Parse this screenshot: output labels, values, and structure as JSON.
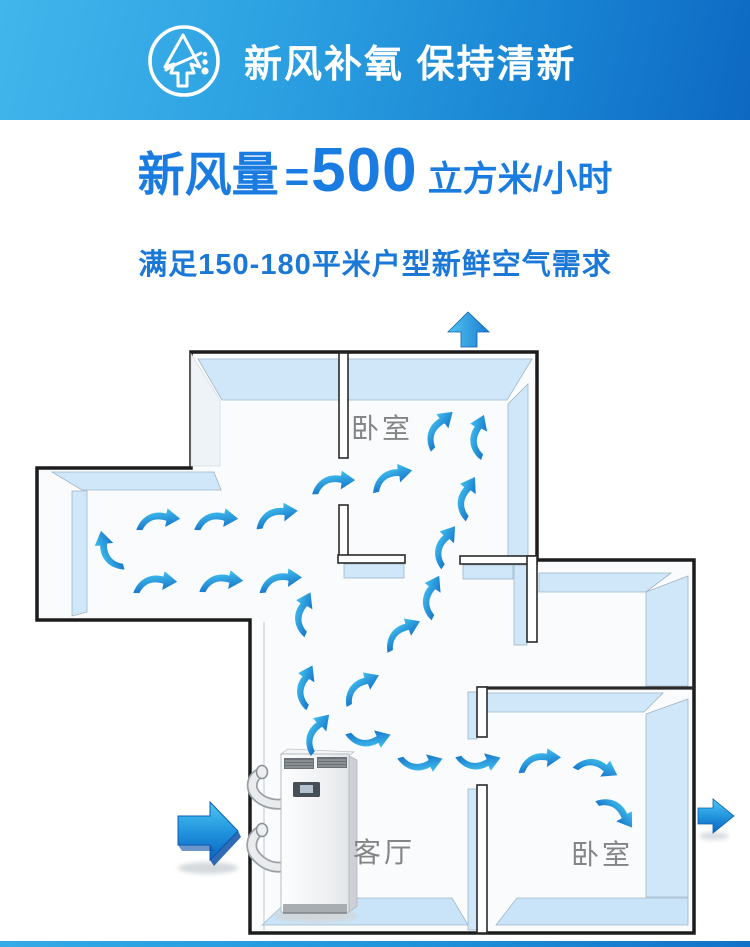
{
  "header": {
    "title": "新风补氧 保持清新",
    "icon": "fresh-air-tree-arrow-icon",
    "gradient": [
      "#41b6ec",
      "#0d68c2"
    ],
    "text_color": "#ffffff"
  },
  "headline": {
    "prefix": "新风量",
    "equals": "=",
    "value": "500",
    "unit": "立方米/小时",
    "color": "#1a7ce0"
  },
  "subtitle": {
    "text": "满足150-180平米户型新鲜空气需求",
    "color": "#1b78d6"
  },
  "floorplan": {
    "rooms": [
      {
        "label": "卧室",
        "position": "top"
      },
      {
        "label": "客厅",
        "position": "bottom-left"
      },
      {
        "label": "卧室",
        "position": "bottom-right"
      }
    ],
    "label_color": "#858585",
    "wall_outline_color": "#1c1c1c",
    "wall_face_color": "#cfe7f8",
    "floor_color": "#c9e4f8",
    "airflow_arrow_color": "#2aa0e2",
    "equipment": "ventilation-unit-cabinet",
    "icons": [
      "air-inlet-arrow-icon",
      "air-outlet-top-arrow-icon",
      "air-outlet-right-arrow-icon",
      "airflow-swoosh-arrow-icon"
    ]
  }
}
